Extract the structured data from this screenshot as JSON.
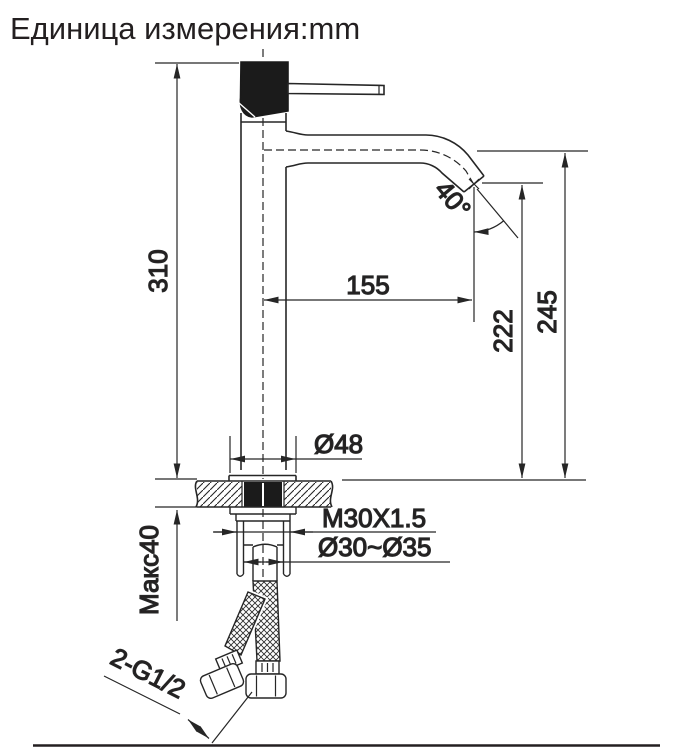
{
  "title": "Единица измерения:mm",
  "drawing": {
    "type": "technical-dimension-drawing",
    "subject": "single-lever tall basin mixer faucet, side view with deck mounting cross-section",
    "unit": "mm",
    "line_color": "#262626",
    "fill_black": "#1b1b1b",
    "dimensions": {
      "total_height": "310",
      "spout_reach": "155",
      "outlet_height": "222",
      "spout_top_height": "245",
      "outlet_angle": "40°",
      "base_diameter": "Ø48",
      "max_deck_thickness": "Макс40",
      "mounting_thread": "M30X1.5",
      "hole_diameter": "Ø30~Ø35",
      "hose_connections": "2-G1/2"
    }
  }
}
